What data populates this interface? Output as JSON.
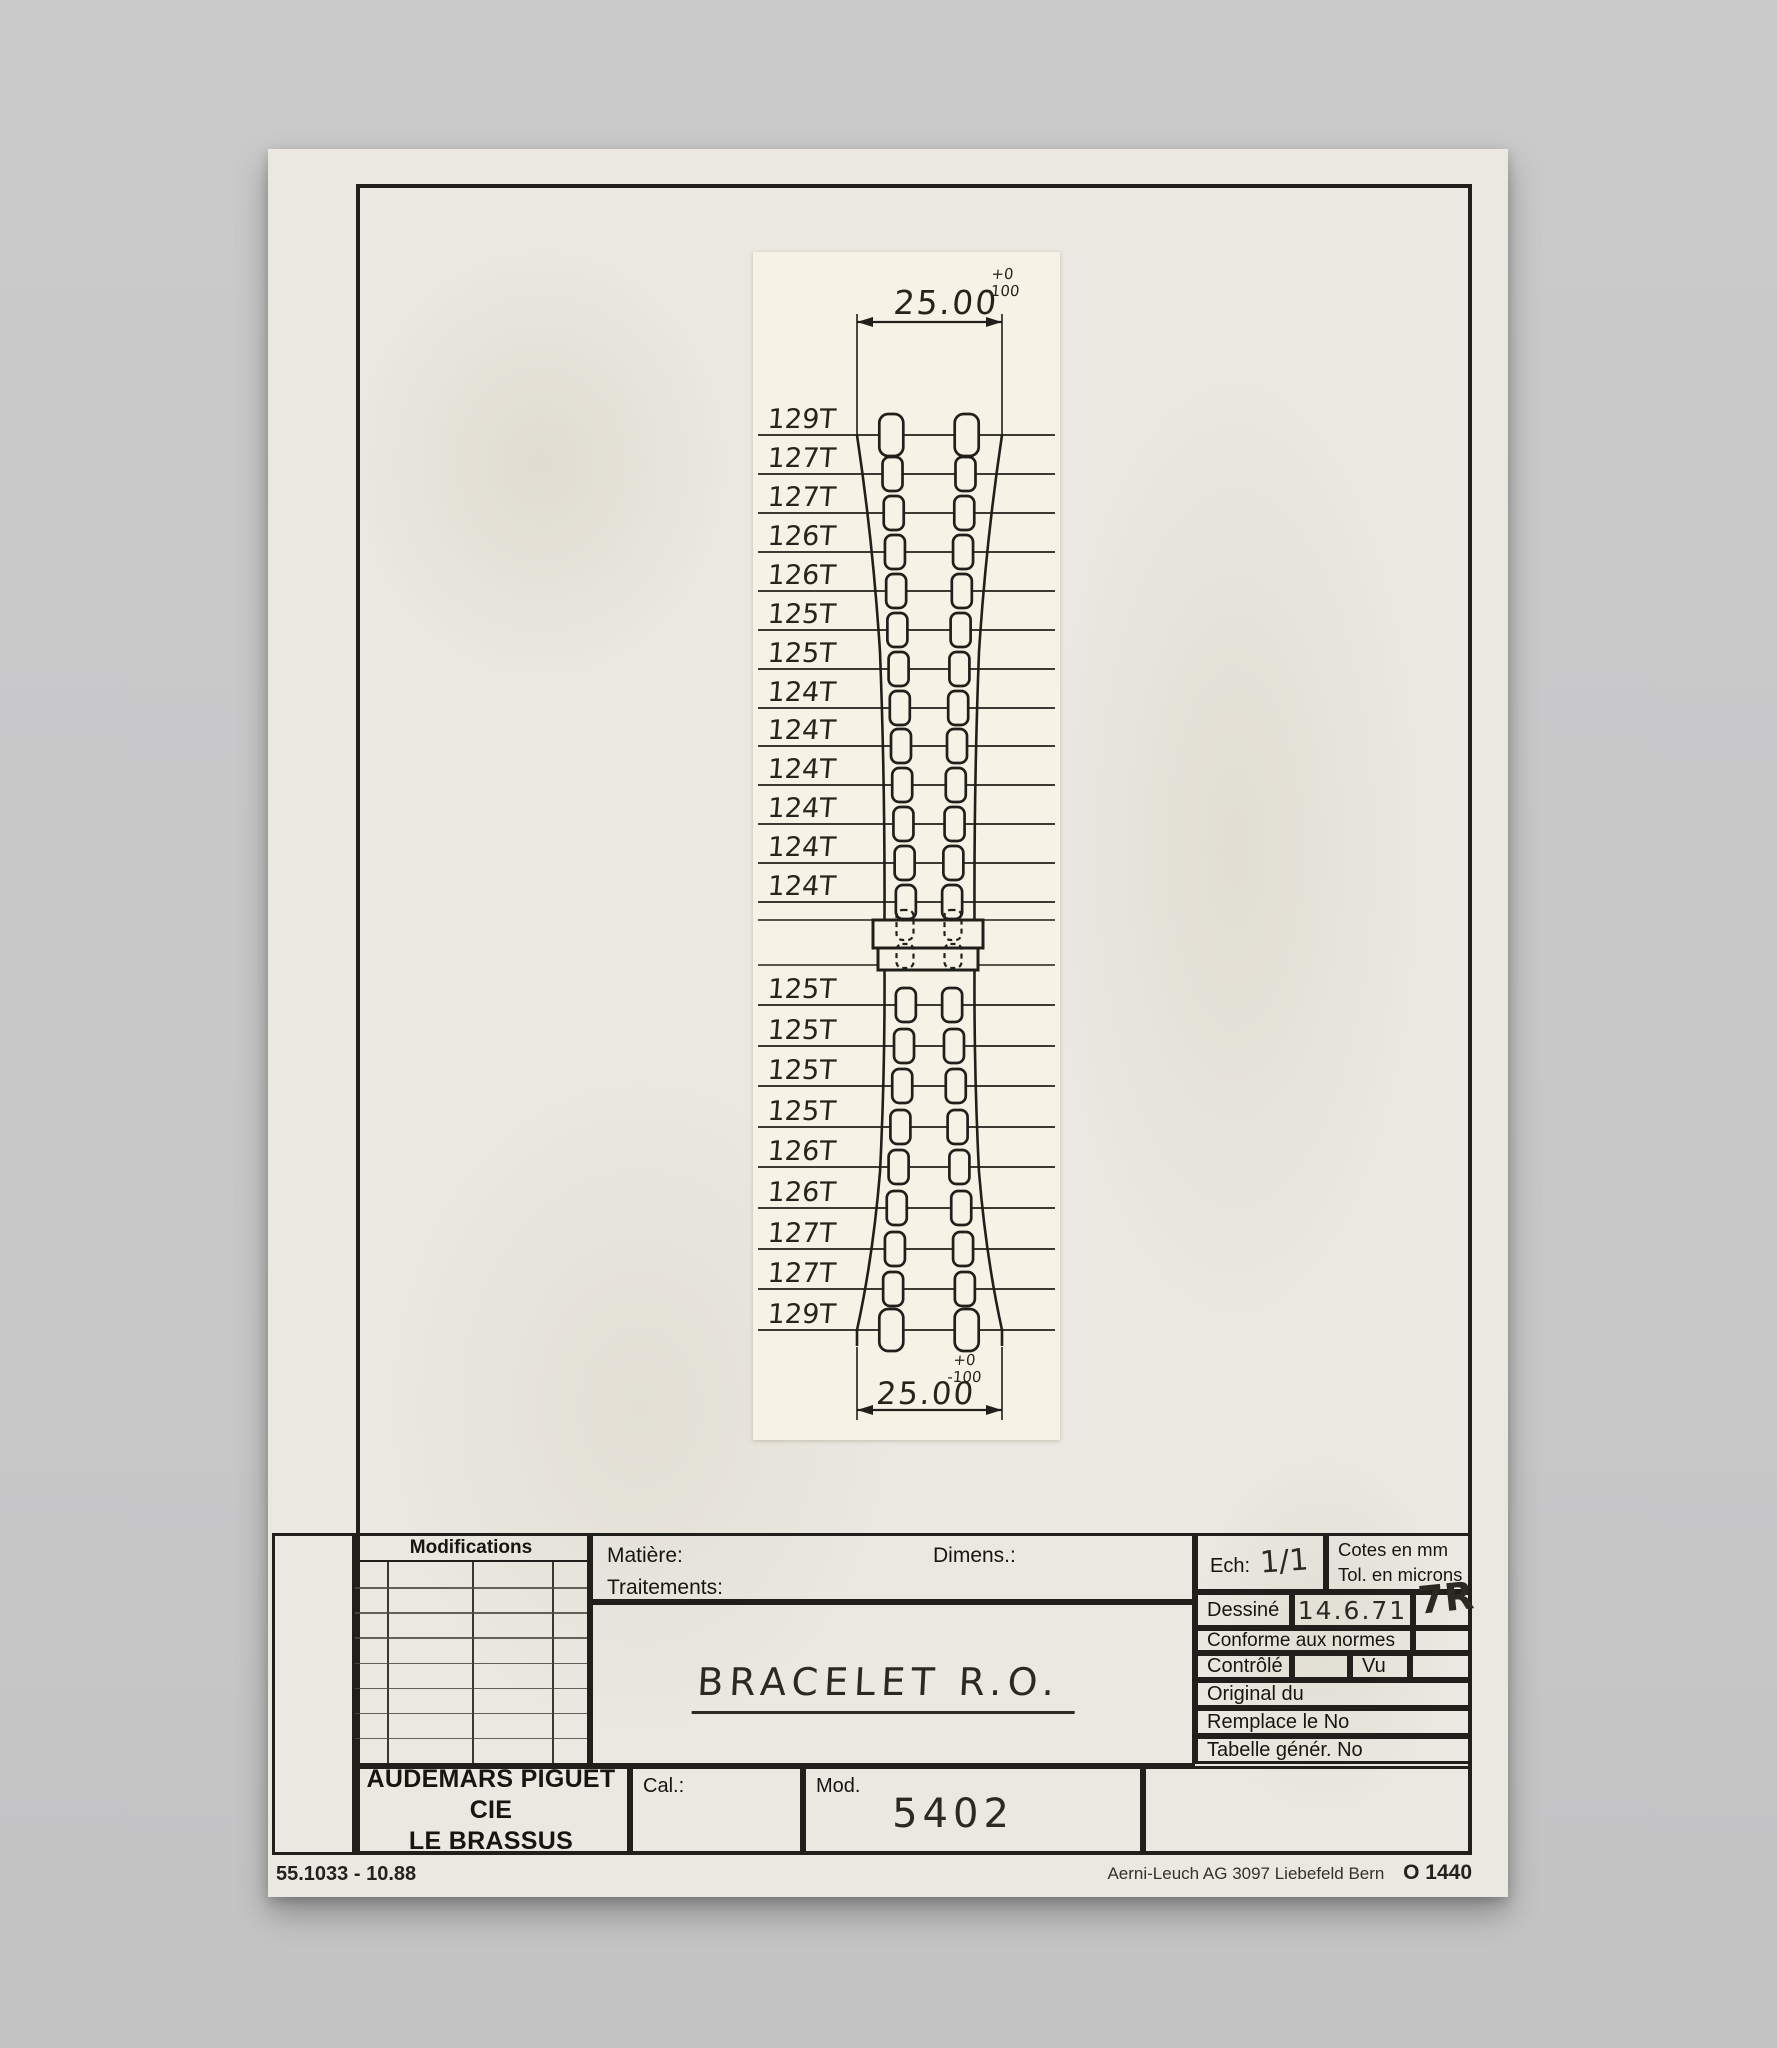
{
  "colors": {
    "background": "#c8c8c9",
    "paper": "#eae8e1",
    "strip": "#f6f3e6",
    "ink": "#211f1b"
  },
  "drawing": {
    "top_dimension": {
      "value": "25.00",
      "tol_plus": "+0",
      "tol_minus": "-100"
    },
    "bottom_dimension": {
      "value": "25.00",
      "tol_plus": "+0",
      "tol_minus": "-100"
    },
    "upper_links": [
      "129T",
      "127T",
      "127T",
      "126T",
      "126T",
      "125T",
      "125T",
      "124T",
      "124T",
      "124T",
      "124T",
      "124T",
      "124T"
    ],
    "lower_links": [
      "125T",
      "125T",
      "125T",
      "125T",
      "126T",
      "126T",
      "127T",
      "127T",
      "129T"
    ]
  },
  "title_block": {
    "modifications_header": "Modifications",
    "matiere_label": "Matière:",
    "traitements_label": "Traitements:",
    "dimens_label": "Dimens.:",
    "designation": "BRACELET  R.O.",
    "ech_label": "Ech:",
    "ech_value": "1/1",
    "cotes_line1": "Cotes en mm",
    "cotes_line2": "Tol. en microns",
    "dessine_label": "Dessiné",
    "dessine_date": "14.6.71",
    "dessine_signature": "7R",
    "conforme_label": "Conforme aux normes",
    "controle_label": "Contrôlé",
    "vu_label": "Vu",
    "original_label": "Original du",
    "remplace_label": "Remplace le No",
    "tabelle_label": "Tabelle génér. No",
    "company_line1": "AUDEMARS PIGUET CIE",
    "company_line2": "LE BRASSUS",
    "cal_label": "Cal.:",
    "mod_label": "Mod.",
    "mod_value": "5402"
  },
  "footer": {
    "left": "55.1033 - 10.88",
    "right": "Aerni-Leuch AG 3097 Liebefeld Bern",
    "code": "O 1440"
  }
}
